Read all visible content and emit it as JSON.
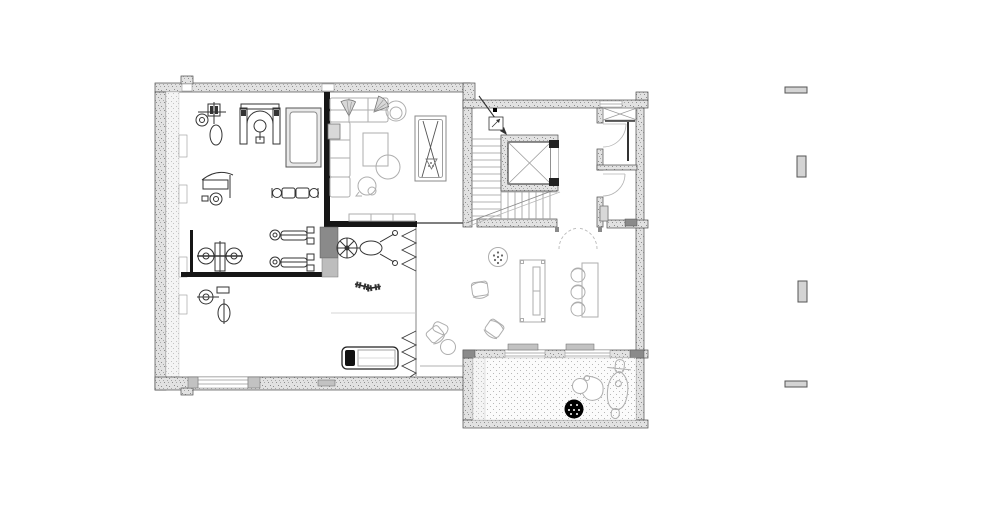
{
  "meta": {
    "drawing_type": "architectural-floor-plan",
    "view": "top-down plan, black-and-white CAD linework on white background",
    "visible_text": "none"
  },
  "colors": {
    "background": "#ffffff",
    "wall_fill": "#e2e2e2",
    "wall_speckle": "#8d8d8d",
    "wall_outline": "#4a4a4a",
    "partition": "#161616",
    "pier_dark": "#8a8a8a",
    "pier_light": "#bdbdbd",
    "furniture_line": "#aeaeae",
    "equipment_line": "#333333",
    "stair_line": "#9a9a9a",
    "glass_line": "#3c3c3c",
    "patio_dot": "#b8b8b8",
    "planter": "#000000",
    "sill_gray": "#c2c2c2"
  },
  "rooms": [
    {
      "name": "gym-room",
      "symbols": [
        "pulldown-machine",
        "multi-press-machine",
        "exercise-mat",
        "pec-deck-machine",
        "bike-pair",
        "row-bench",
        "row-bench",
        "bench-press"
      ]
    },
    {
      "name": "open-gym-area",
      "symbols": [
        "lat-machine",
        "cable-crossover-machine",
        "dumbbells",
        "treadmill",
        "glass-partition-zigzag"
      ]
    },
    {
      "name": "lounge",
      "symbols": [
        "l-sofa",
        "throw-pillow-fan",
        "throw-pillow-fan",
        "round-armchair",
        "side-table",
        "coffee-table-square",
        "coffee-table-round",
        "teardrop-chair",
        "sideboard",
        "billiard-table-with-cues-and-rack"
      ]
    },
    {
      "name": "stair-hall",
      "symbols": [
        "staircase-upper-run",
        "staircase-lower-run",
        "break-line",
        "entry-arrow",
        "stair-tag"
      ]
    },
    {
      "name": "elevator",
      "symbols": [
        "elevator-shaft-x"
      ]
    },
    {
      "name": "closet-room",
      "symbols": [
        "wardrobe-x",
        "hanging-rod",
        "swing-door"
      ]
    },
    {
      "name": "wc-room",
      "symbols": [
        "swing-door",
        "fixture-block"
      ]
    },
    {
      "name": "bar-lounge",
      "symbols": [
        "french-double-door",
        "round-game-table",
        "armchair",
        "armchair",
        "bar-counter",
        "bar-stool",
        "bar-stool",
        "bar-stool",
        "island-table",
        "lounge-chair-group"
      ]
    },
    {
      "name": "terrace",
      "symbols": [
        "stippled-paving",
        "scooter",
        "beanbag-lounger",
        "round-patio-table",
        "black-dot-planter"
      ]
    }
  ],
  "side_markers": [
    {
      "name": "wall-segment-marker-horizontal-top"
    },
    {
      "name": "wall-segment-marker-vertical-upper"
    },
    {
      "name": "wall-segment-marker-vertical-lower"
    },
    {
      "name": "wall-segment-marker-horizontal-bottom"
    }
  ]
}
